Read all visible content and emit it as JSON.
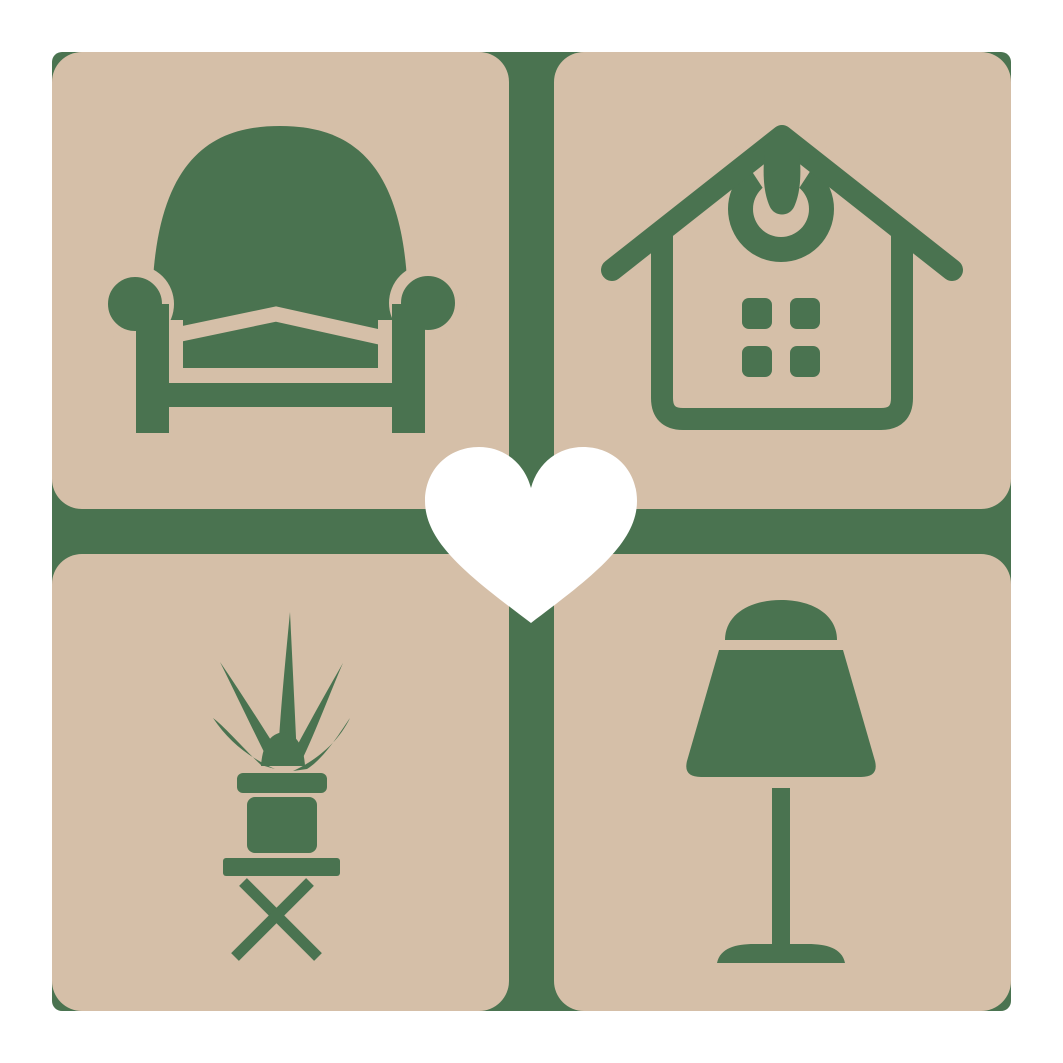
{
  "logo": {
    "name": "home-decor-furniture-logo",
    "page_background": "#FFFFFF",
    "colors": {
      "green": "#4A7350",
      "tan": "#D5BFA8",
      "heart": "#FFFFFF"
    },
    "tiles": [
      {
        "position": "top-left",
        "icon": "armchair-icon"
      },
      {
        "position": "top-right",
        "icon": "house-icon"
      },
      {
        "position": "bottom-left",
        "icon": "potted-plant-on-table-icon"
      },
      {
        "position": "bottom-right",
        "icon": "table-lamp-icon"
      }
    ],
    "center_icon": "heart-icon"
  }
}
